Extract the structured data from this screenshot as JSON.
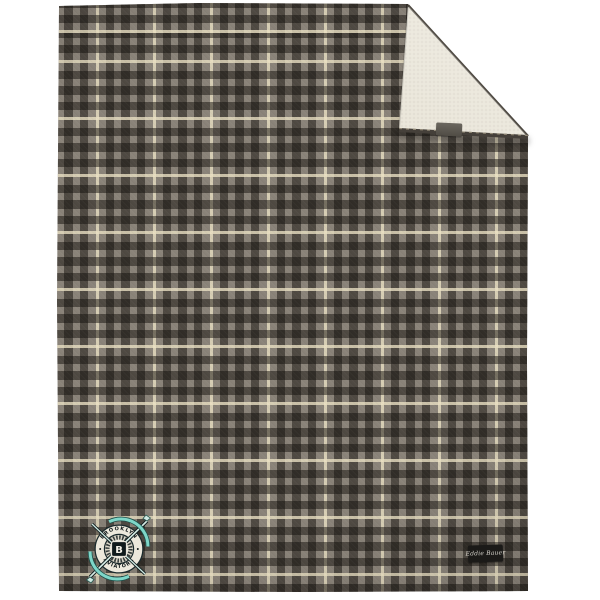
{
  "product": {
    "description": "Gray and cream plaid fleece blanket with folded corner showing sherpa lining",
    "brand_tag": {
      "label": "Eddie Bauer"
    },
    "patch": {
      "top_text": "BROOKLYN",
      "bottom_text": "AVIATORS",
      "center_letter": "B"
    },
    "colors": {
      "plaid_base": "#8a8379",
      "plaid_dark": "#312e29",
      "plaid_cream": "#e3dabd",
      "sherpa": "#e6e1d2",
      "patch_teal": "#7ed6c8",
      "patch_dark": "#10181a",
      "tag_black": "#1b1a18",
      "background": "#ffffff"
    }
  }
}
